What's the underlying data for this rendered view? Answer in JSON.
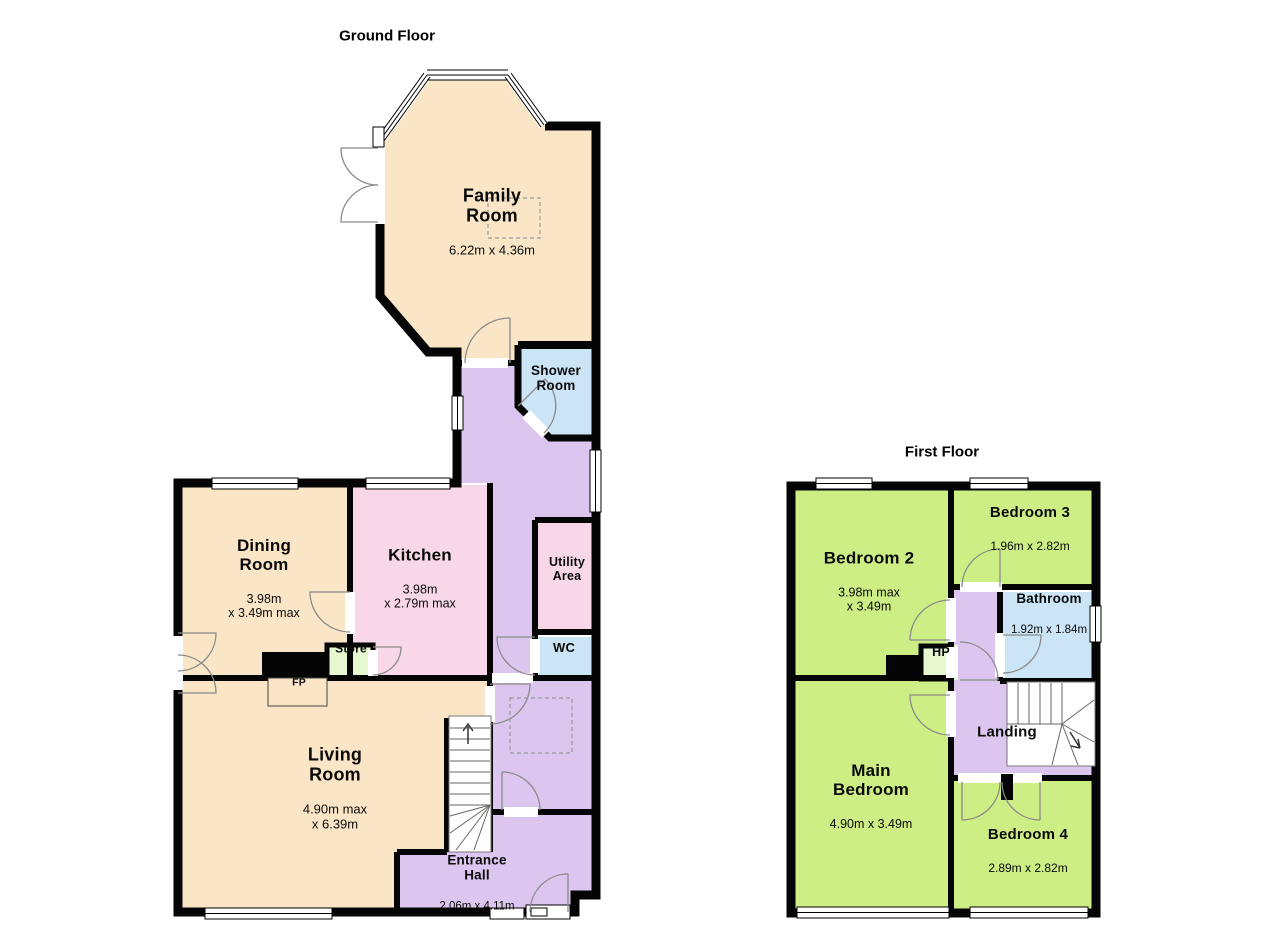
{
  "colors": {
    "wall": "#050505",
    "cream": "#FAE6C6",
    "pink": "#F8D8E8",
    "blue": "#CBE5F6",
    "purple": "#DCC6F0",
    "green": "#CCEE85",
    "pale_green": "#E7F8D0",
    "white": "#FFFFFF"
  },
  "ground_floor": {
    "title": "Ground Floor",
    "rooms": {
      "family_room": {
        "name": "Family\nRoom",
        "dims": "6.22m x 4.36m"
      },
      "shower_room": {
        "name": "Shower\nRoom",
        "dims": ""
      },
      "dining_room": {
        "name": "Dining\nRoom",
        "dims": "3.98m\nx 3.49m max"
      },
      "kitchen": {
        "name": "Kitchen",
        "dims": "3.98m\nx 2.79m max"
      },
      "utility_area": {
        "name": "Utility\nArea",
        "dims": ""
      },
      "wc": {
        "name": "WC",
        "dims": ""
      },
      "store": {
        "name": "Store",
        "dims": ""
      },
      "fireplace": {
        "name": "FP",
        "dims": ""
      },
      "living_room": {
        "name": "Living\nRoom",
        "dims": "4.90m max\nx 6.39m"
      },
      "entrance_hall": {
        "name": "Entrance\nHall",
        "dims": "2.06m x 4.11m"
      }
    }
  },
  "first_floor": {
    "title": "First Floor",
    "rooms": {
      "bedroom_2": {
        "name": "Bedroom 2",
        "dims": "3.98m max\nx 3.49m"
      },
      "bedroom_3": {
        "name": "Bedroom 3",
        "dims": "1.96m x 2.82m"
      },
      "bathroom": {
        "name": "Bathroom",
        "dims": "1.92m x 1.84m"
      },
      "hot_press": {
        "name": "HP",
        "dims": ""
      },
      "landing": {
        "name": "Landing",
        "dims": ""
      },
      "main_bedroom": {
        "name": "Main\nBedroom",
        "dims": "4.90m x 3.49m"
      },
      "bedroom_4": {
        "name": "Bedroom 4",
        "dims": "2.89m x 2.82m"
      }
    }
  }
}
